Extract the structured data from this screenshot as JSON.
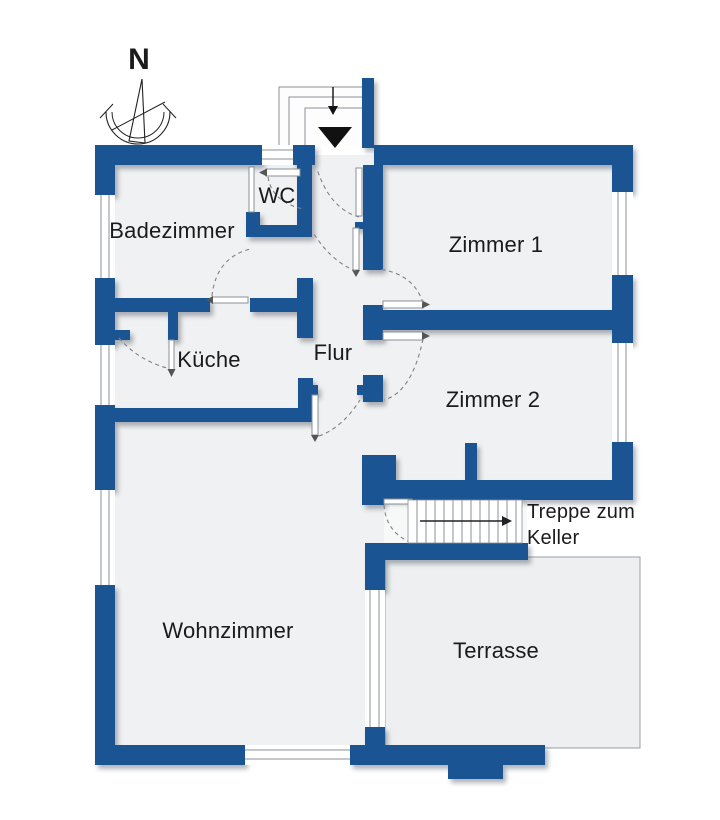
{
  "title": "Grundriss Erdgeschoss",
  "colors": {
    "wall": "#1a5493",
    "floor": "#f0f1f2",
    "terrace": "#edeff0",
    "line": "#8a9097",
    "text": "#1b1b1b",
    "ink": "#111111"
  },
  "compass": {
    "label": "N"
  },
  "entrance": {
    "arrow_icon": "down-arrow-icon",
    "marker_icon": "black-triangle-marker"
  },
  "rooms": [
    {
      "id": "wc",
      "label": "WC"
    },
    {
      "id": "badezimmer",
      "label": "Badezimmer"
    },
    {
      "id": "zimmer1",
      "label": "Zimmer 1"
    },
    {
      "id": "kueche",
      "label": "Küche"
    },
    {
      "id": "flur",
      "label": "Flur"
    },
    {
      "id": "zimmer2",
      "label": "Zimmer 2"
    },
    {
      "id": "wohnzimmer",
      "label": "Wohnzimmer"
    },
    {
      "id": "terrasse",
      "label": "Terrasse"
    }
  ],
  "stairs": {
    "label_line1": "Treppe zum",
    "label_line2": "Keller",
    "direction": "right",
    "treads": 12
  }
}
